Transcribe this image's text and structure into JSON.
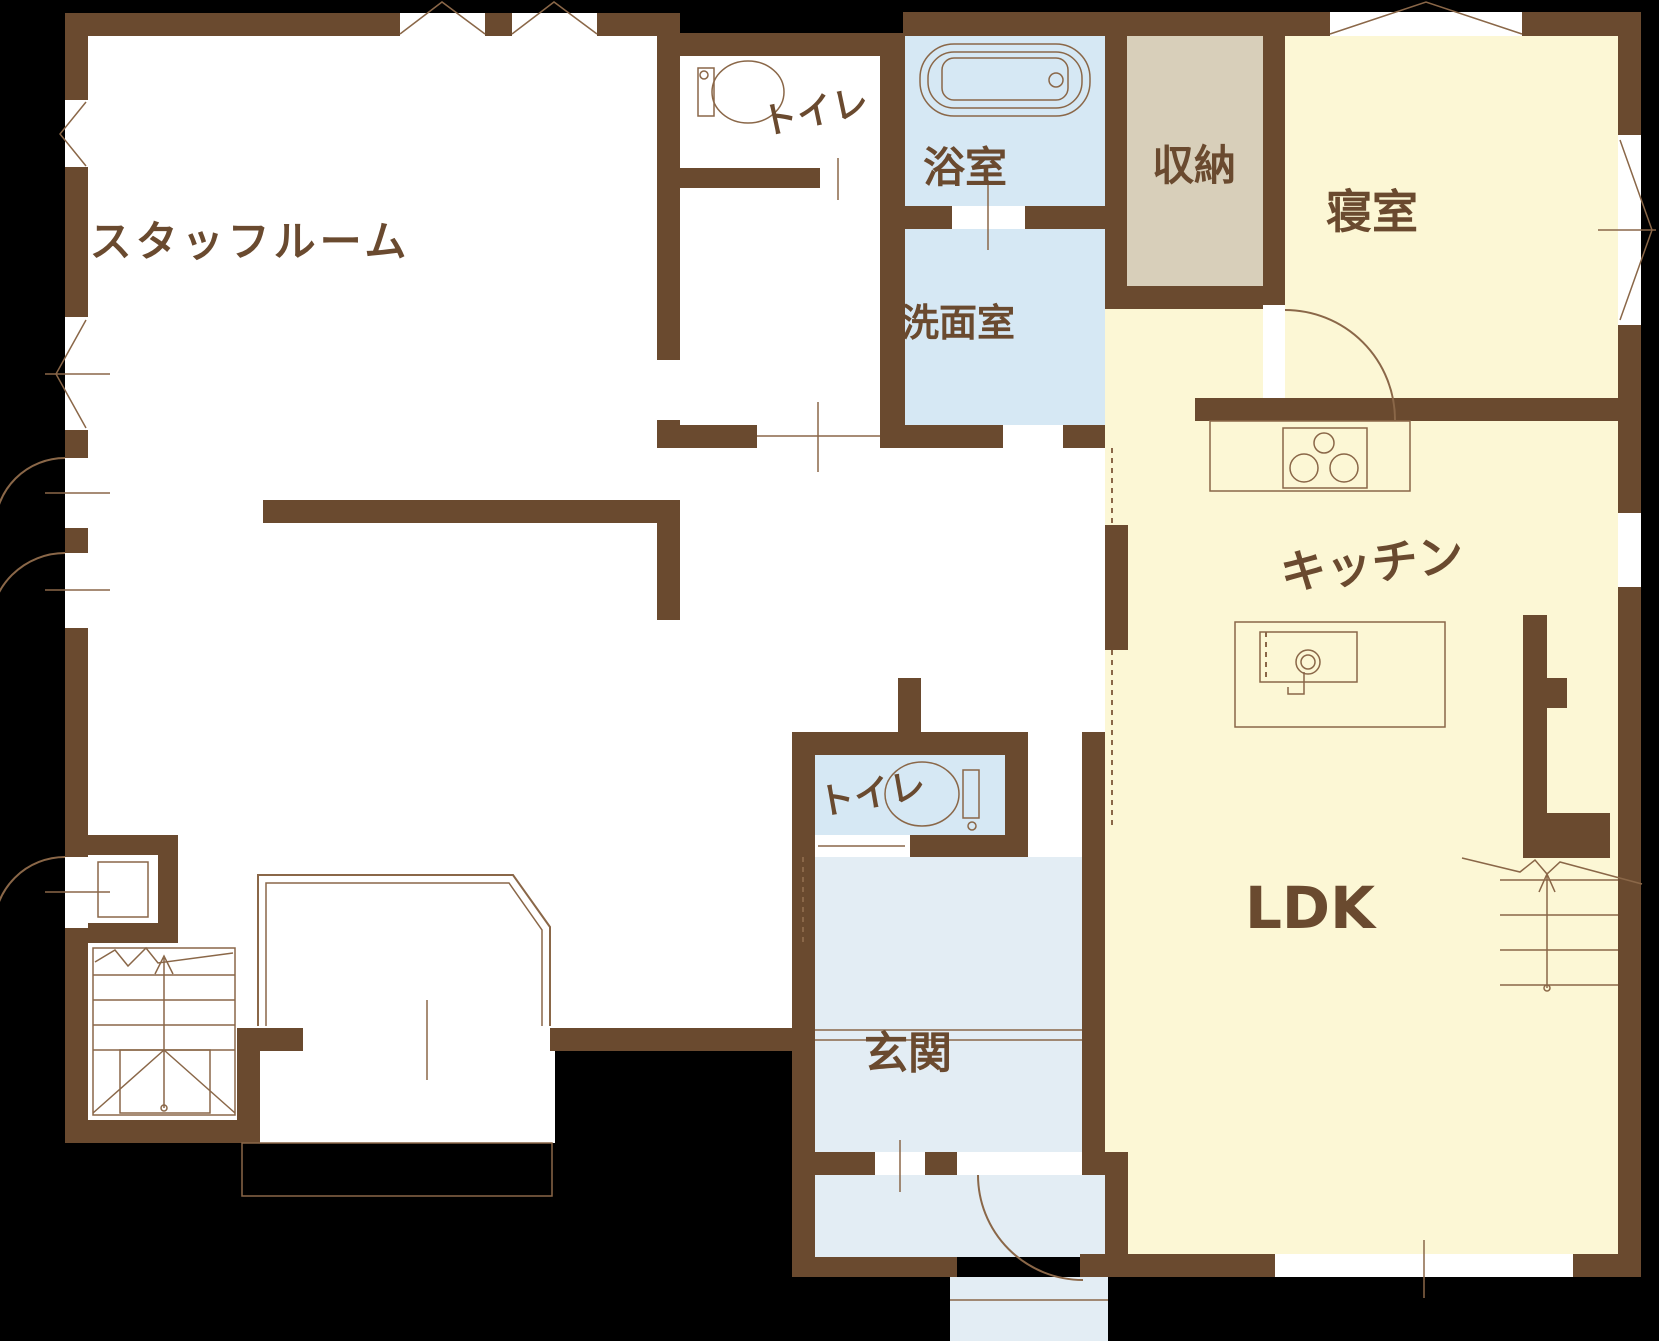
{
  "plan_title": "1F floor plan",
  "colors": {
    "bg": "#000000",
    "wall": "#6a4a2f",
    "line": "#8a6748",
    "label": "#6a4a2f",
    "white": "#ffffff",
    "yellow": "#fcf7d5",
    "blue": "#d6e8f4",
    "blue_light": "#e3edf4",
    "beige": "#d8cfba"
  },
  "rooms": {
    "staff_room": {
      "label": "スタッフルーム"
    },
    "toilet_upper": {
      "label": "トイレ"
    },
    "bathroom": {
      "label": "浴室"
    },
    "washroom": {
      "label": "洗面室"
    },
    "storage": {
      "label": "収納"
    },
    "bedroom": {
      "label": "寝室"
    },
    "kitchen": {
      "label": "キッチン"
    },
    "ldk": {
      "label": "LDK"
    },
    "toilet_lower": {
      "label": "トイレ"
    },
    "entrance": {
      "label": "玄関"
    }
  }
}
